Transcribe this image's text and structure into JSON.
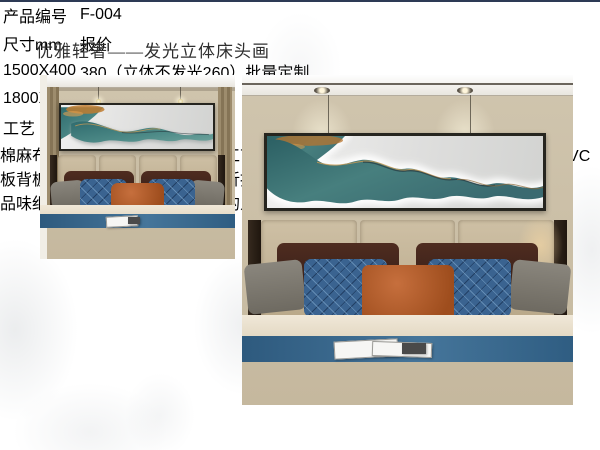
{
  "page": {
    "title": "优雅轻奢——发光立体床头画"
  },
  "product_table": {
    "rows": [
      {
        "label": "产品编号",
        "value": "F-004"
      },
      {
        "label": "尺寸mm",
        "value": "报价"
      },
      {
        "label": "1500X400",
        "value": "380（立体不发光260）批量定制"
      },
      {
        "label": "1800X480",
        "value": "530（立体不发光360）批量定制"
      }
    ],
    "craft_label": "工艺",
    "craft_description": "棉麻布精喷，博物馆艺术品复制工艺，立体发光（不发光），PS环保画框，环保PVC板背板，量大免木架费。物流有折扣。"
  },
  "photos": {
    "left_alt": "卧室床头画整体效果图",
    "right_alt": "发光立体床头画近景效果图"
  },
  "footer": {
    "slogan": "品味细腻优雅的艺术，营造浓厚的人文气息！"
  },
  "colors": {
    "accent_navy": "#2d3a55",
    "art_teal": "#3f7a7c",
    "art_teal_dark": "#27454f",
    "accent_orange": "#b4592a",
    "wall_beige": "#cbbfa8",
    "runner_blue": "#3a678c",
    "duvet_tan": "#b2a088",
    "table_border": "#4f4f4f"
  }
}
